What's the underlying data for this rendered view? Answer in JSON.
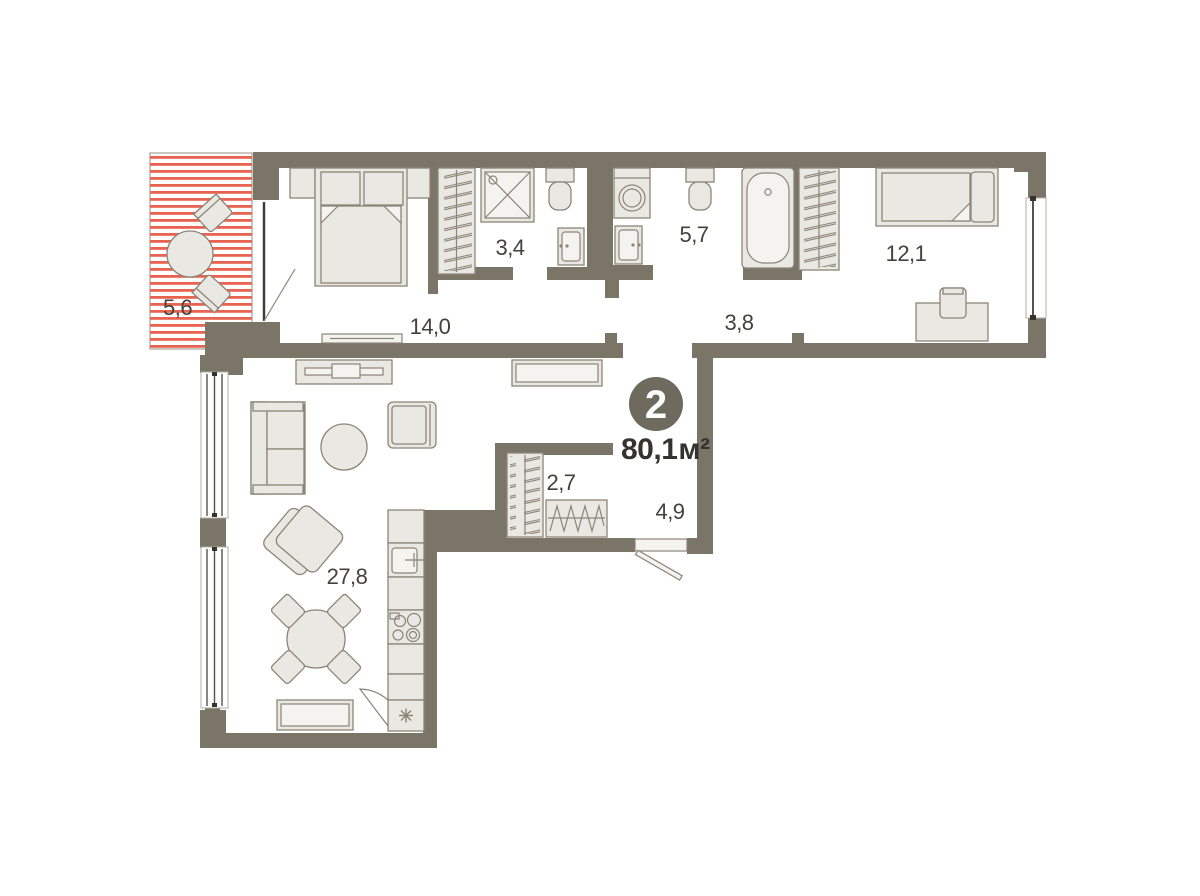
{
  "plan": {
    "rooms_count": "2",
    "total_area": "80,1",
    "area_unit": "м²"
  },
  "rooms": [
    {
      "name": "living-kitchen",
      "area": "27,8"
    },
    {
      "name": "bedroom",
      "area": "14,0"
    },
    {
      "name": "bedroom-2",
      "area": "12,1"
    },
    {
      "name": "bathroom",
      "area": "5,7"
    },
    {
      "name": "shower-room",
      "area": "3,4"
    },
    {
      "name": "hallway",
      "area": "3,8"
    },
    {
      "name": "entrance-hall",
      "area": "4,9"
    },
    {
      "name": "closet",
      "area": "2,7"
    },
    {
      "name": "balcony",
      "area": "5,6"
    }
  ],
  "colors": {
    "wall": "#7b7568",
    "furniture_fill": "#eae8e3",
    "furniture_stroke": "#8b8577",
    "balcony_stripe": "#e86350",
    "label_text": "#45423c",
    "badge_bg": "#6f6a5e",
    "badge_text": "#ffffff"
  }
}
